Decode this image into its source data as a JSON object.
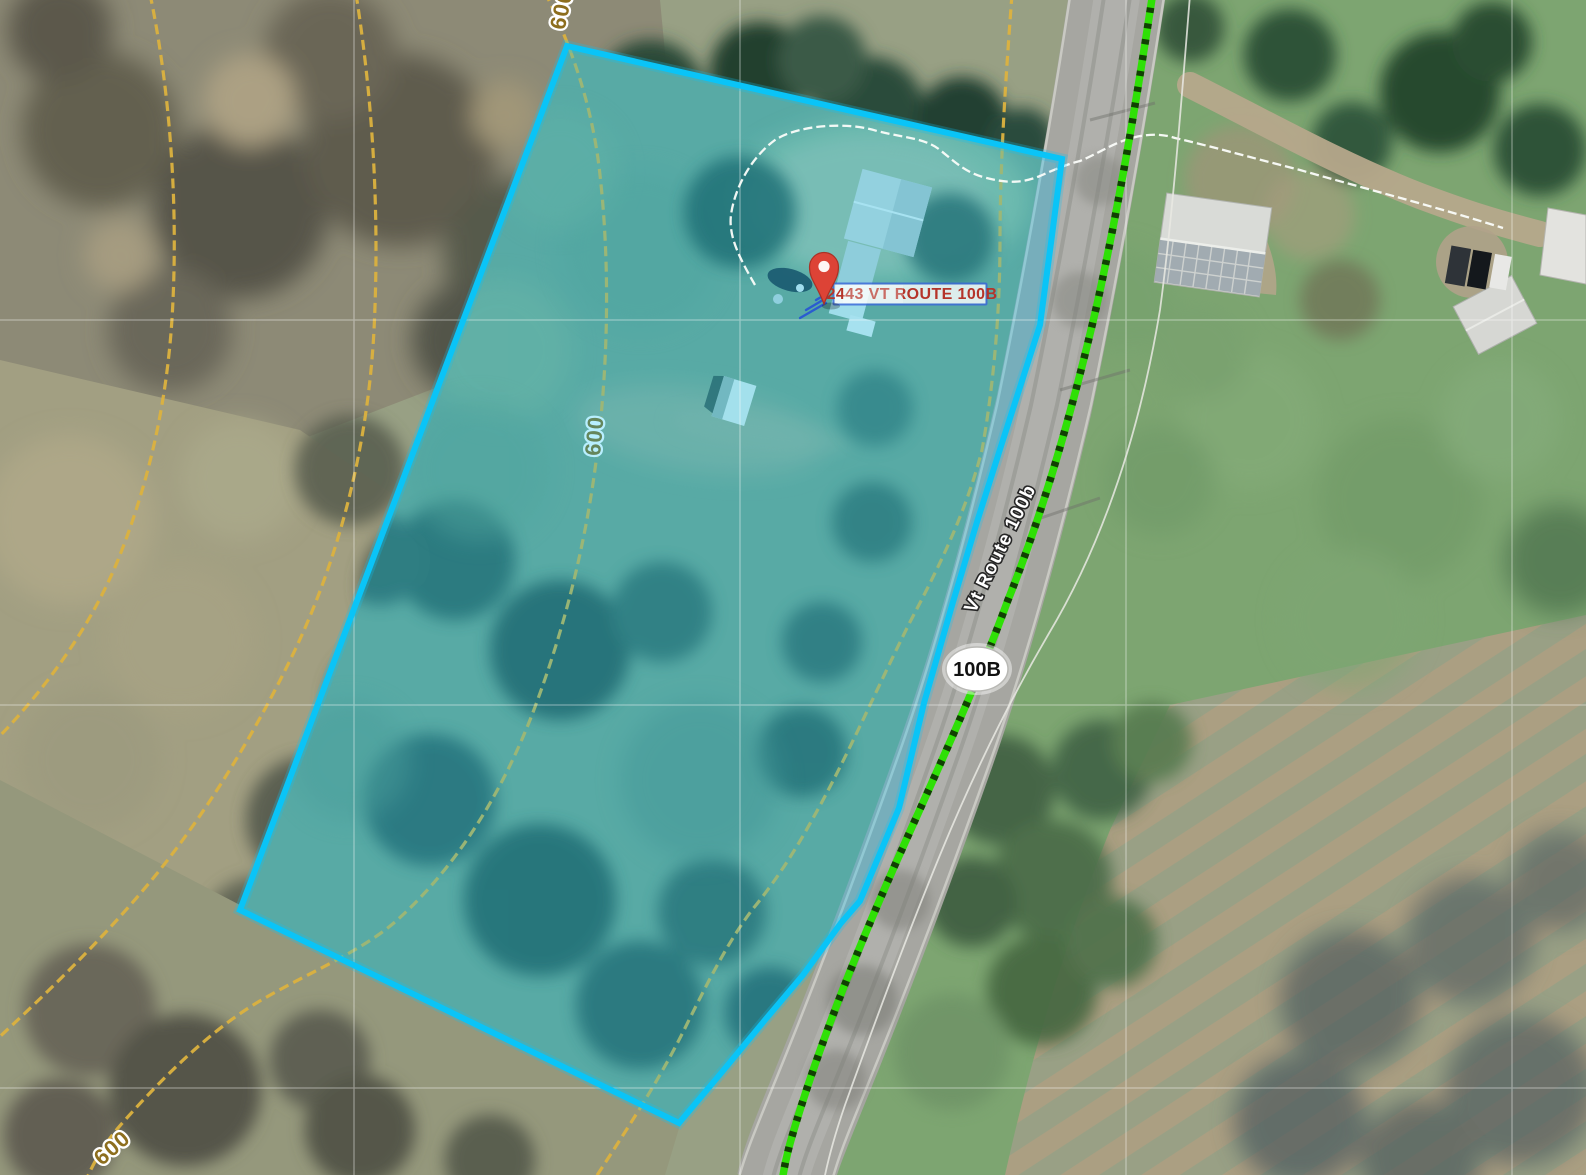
{
  "map": {
    "marker": {
      "address_label": "2443 VT ROUTE 100B"
    },
    "road": {
      "shield_label": "100B",
      "name_label": "Vt Route 100b"
    },
    "contours": {
      "elevation_label": "600"
    },
    "colors": {
      "parcel_stroke": "#0ac4f7",
      "parcel_fill": "rgba(0,196,255,0.28)",
      "contour_line": "#dcb23f",
      "contour_text": "#8d6e1e",
      "route_green": "#2fe006",
      "route_dash": "#0e2f03",
      "pin_red": "#dd4336",
      "address_text": "#b5342a",
      "address_border": "#3a66d9",
      "shield_text": "#111111"
    }
  }
}
